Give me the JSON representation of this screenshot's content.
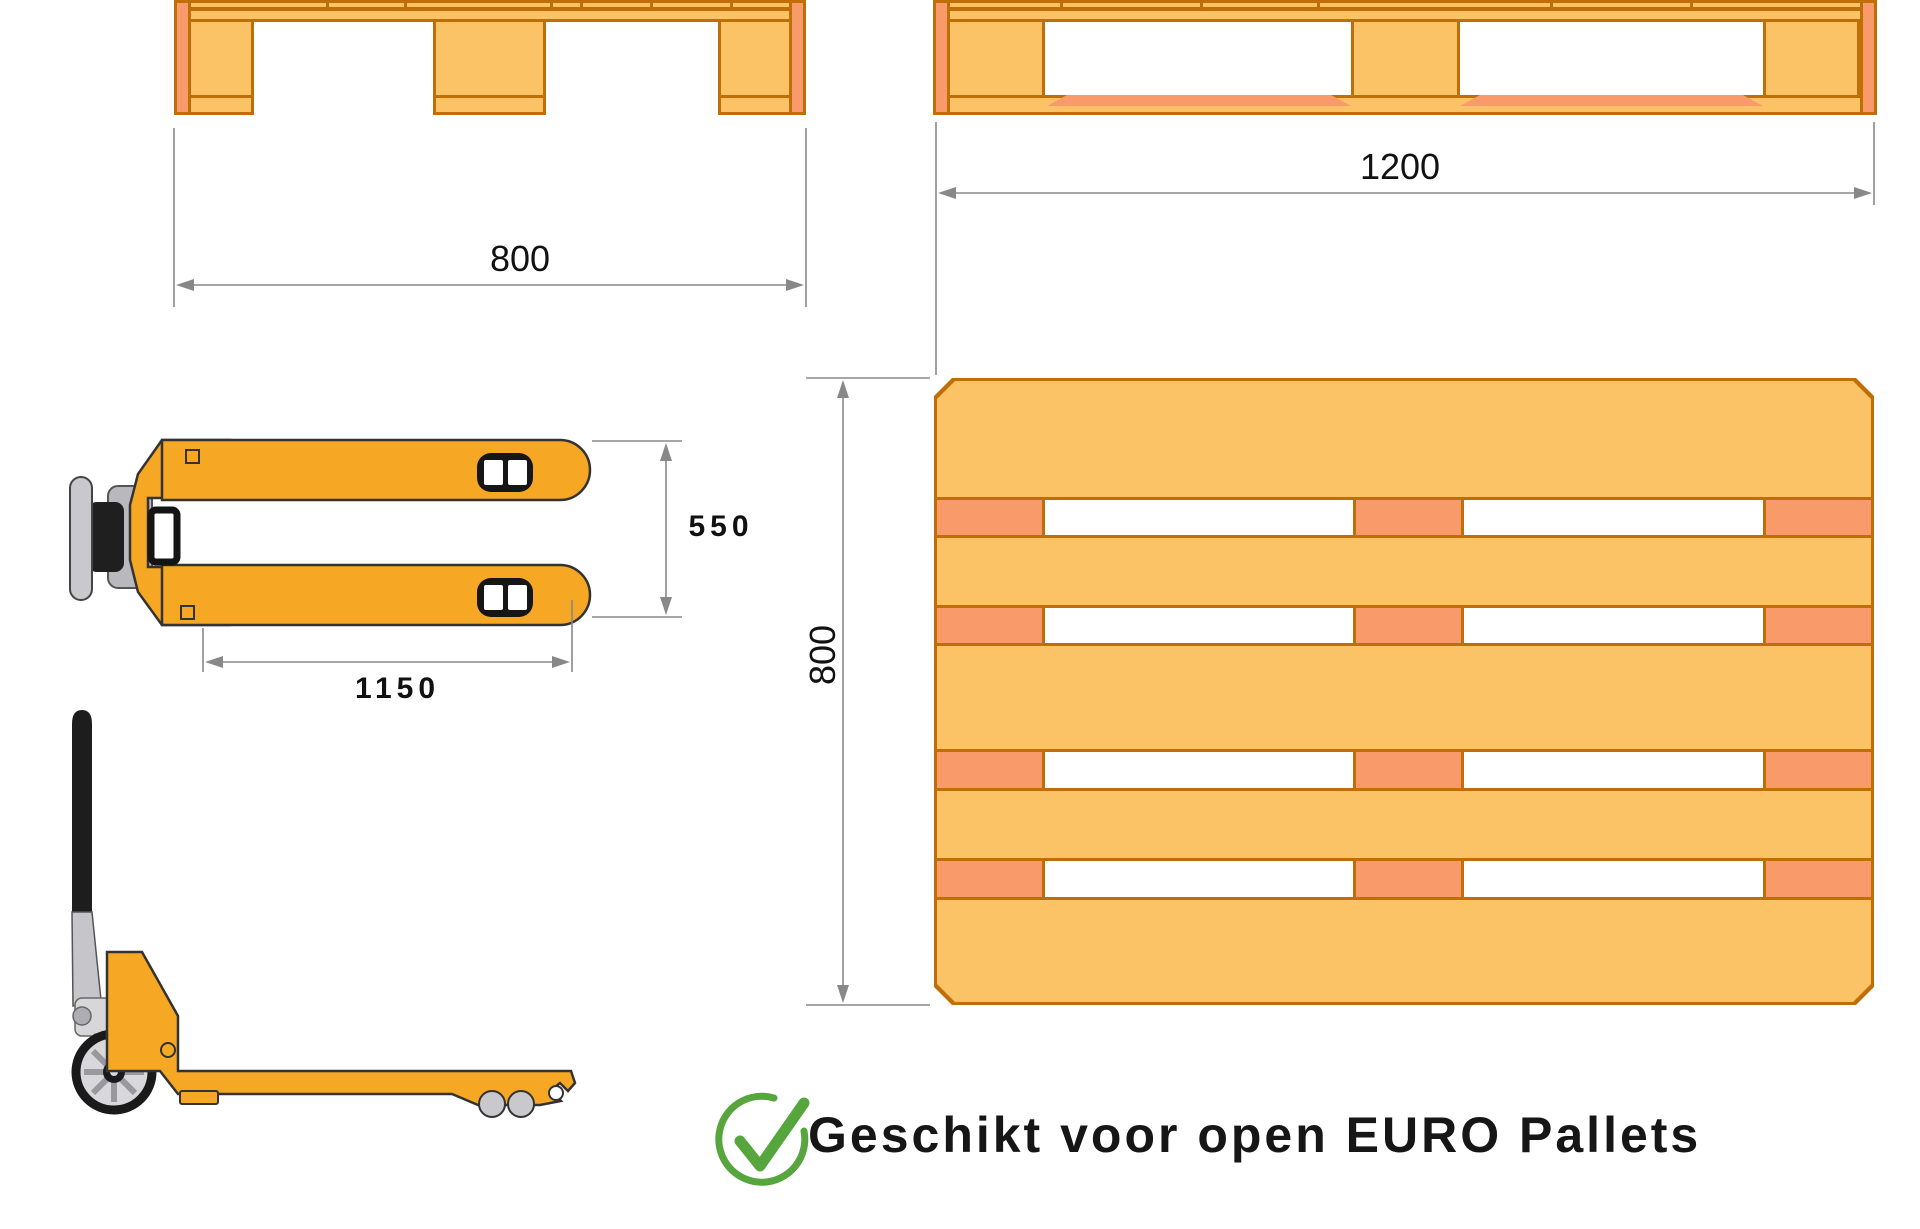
{
  "dimensions": {
    "front_width_mm": "800",
    "side_length_mm": "1200",
    "top_width_mm": "800",
    "fork_span_mm": "550",
    "fork_length_mm": "1150"
  },
  "caption": {
    "text": "Geschikt voor open EURO Pallets"
  },
  "colors": {
    "pallet_fill": "#FCC266",
    "pallet_accent": "#F89A6A",
    "pallet_outline": "#C06F08",
    "jack_yellow": "#F6A723",
    "check_green": "#56A53D",
    "dimension_line": "#888888"
  }
}
